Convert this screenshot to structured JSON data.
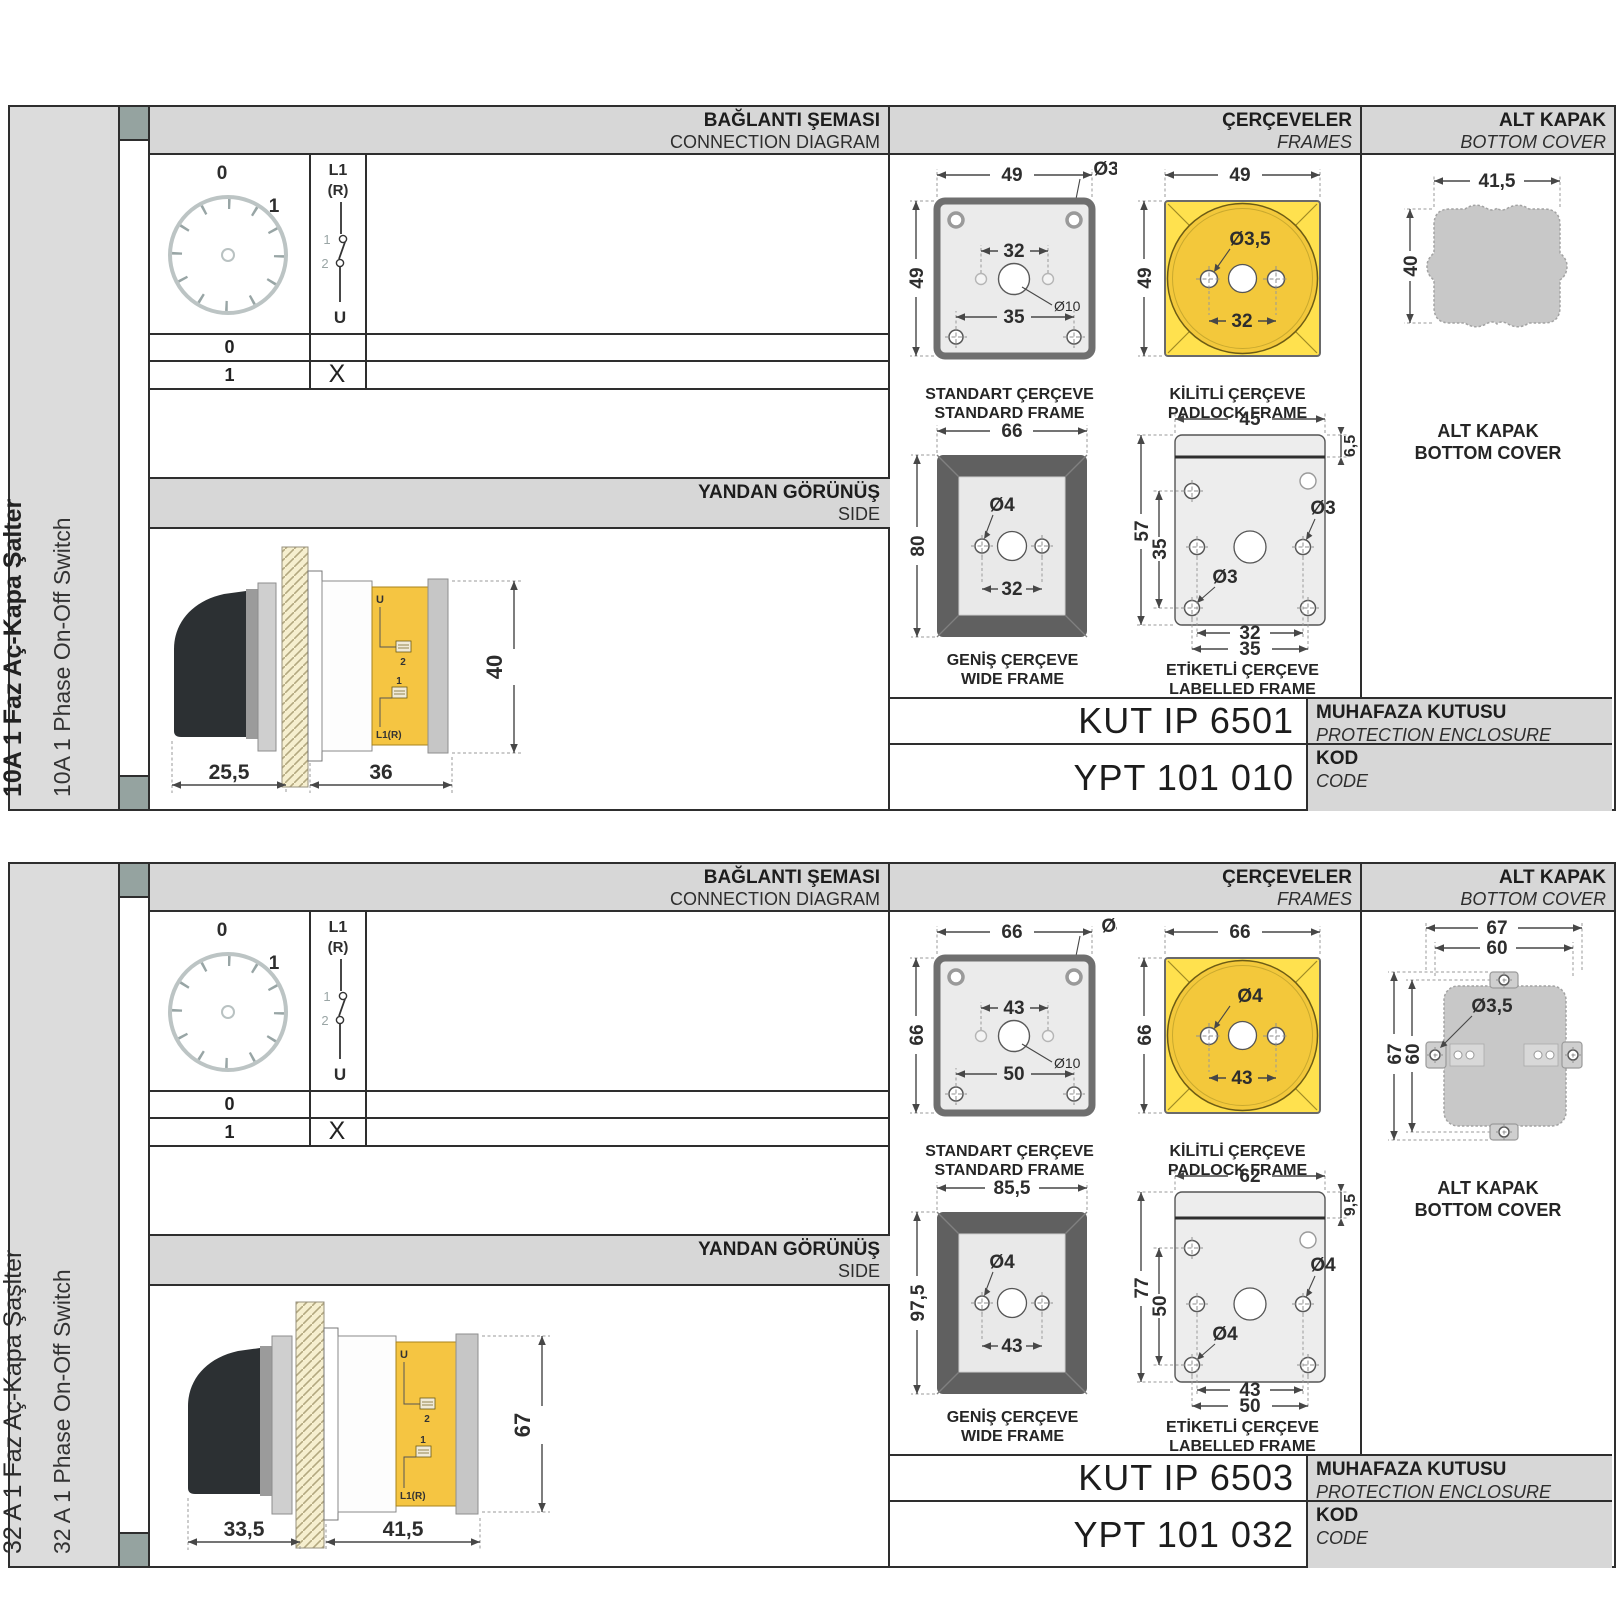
{
  "panels": [
    {
      "sidebar": {
        "title_tr": "10A 1 Faz Aç-Kapa Şalter",
        "title_en": "10A 1 Phase On-Off Switch"
      },
      "headers": {
        "connection_tr": "BAĞLANTI ŞEMASI",
        "connection_en": "CONNECTION DIAGRAM",
        "frames_tr": "ÇERÇEVELER",
        "frames_en": "FRAMES",
        "cover_tr": "ALT KAPAK",
        "cover_en": "BOTTOM COVER",
        "side_tr": "YANDAN GÖRÜNÜŞ",
        "side_en": "SIDE"
      },
      "connection": {
        "dial_zero": "0",
        "dial_one": "1",
        "line_in": "L1",
        "line_in2": "(R)",
        "contact_top": "1",
        "contact_bottom": "2",
        "line_out": "U",
        "rows": [
          {
            "pos": "0",
            "mark": ""
          },
          {
            "pos": "1",
            "mark": "X"
          }
        ]
      },
      "side_view": {
        "dim_handle": "25,5",
        "dim_body": "36",
        "dim_height": "40",
        "label_u": "U",
        "label_2": "2",
        "label_1": "1",
        "label_l1": "L1(R)"
      },
      "frames": {
        "standard": {
          "caption_tr": "STANDART ÇERÇEVE",
          "caption_en": "STANDARD FRAME",
          "dim_width": "49",
          "dim_height": "49",
          "dim_holes": "32",
          "dim_bottom": "35",
          "hole_corner": "Ø3,5",
          "hole_center": "Ø10"
        },
        "padlock": {
          "caption_tr": "KİLİTLİ ÇERÇEVE",
          "caption_en": "PADLOCK FRAME",
          "dim_width": "49",
          "dim_height": "49",
          "dim_holes": "32",
          "hole": "Ø3,5"
        },
        "wide": {
          "caption_tr": "GENİŞ ÇERÇEVE",
          "caption_en": "WIDE FRAME",
          "dim_width": "66",
          "dim_height": "80",
          "dim_holes": "32",
          "hole": "Ø4"
        },
        "labelled": {
          "caption_tr": "ETİKETLİ ÇERÇEVE",
          "caption_en": "LABELLED FRAME",
          "dim_width": "45",
          "dim_strip": "6,5",
          "dim_height": "57",
          "dim_inner": "35",
          "hole_mid": "Ø3",
          "hole_bottom": "Ø3",
          "dim_holes_inner": "32",
          "dim_holes_outer": "35"
        }
      },
      "cover": {
        "caption_tr": "ALT KAPAK",
        "caption_en": "BOTTOM COVER",
        "dim_width": "41,5",
        "dim_height": "40"
      },
      "codes": {
        "enclosure_value": "KUT IP 6501",
        "enclosure_tr": "MUHAFAZA KUTUSU",
        "enclosure_en": "PROTECTION ENCLOSURE",
        "code_value": "YPT 101 010",
        "code_tr": "KOD",
        "code_en": "CODE"
      }
    },
    {
      "sidebar": {
        "title_tr": "32 A 1 Faz Aç-Kapa Şaşlter",
        "title_en": "32 A 1 Phase On-Off Switch"
      },
      "headers": {
        "connection_tr": "BAĞLANTI ŞEMASI",
        "connection_en": "CONNECTION DIAGRAM",
        "frames_tr": "ÇERÇEVELER",
        "frames_en": "FRAMES",
        "cover_tr": "ALT KAPAK",
        "cover_en": "BOTTOM COVER",
        "side_tr": "YANDAN GÖRÜNÜŞ",
        "side_en": "SIDE"
      },
      "connection": {
        "dial_zero": "0",
        "dial_one": "1",
        "line_in": "L1",
        "line_in2": "(R)",
        "contact_top": "1",
        "contact_bottom": "2",
        "line_out": "U",
        "rows": [
          {
            "pos": "0",
            "mark": ""
          },
          {
            "pos": "1",
            "mark": "X"
          }
        ]
      },
      "side_view": {
        "dim_handle": "33,5",
        "dim_body": "41,5",
        "dim_height": "67",
        "label_u": "U",
        "label_2": "2",
        "label_1": "1",
        "label_l1": "L1(R)"
      },
      "frames": {
        "standard": {
          "caption_tr": "STANDART ÇERÇEVE",
          "caption_en": "STANDARD FRAME",
          "dim_width": "66",
          "dim_height": "66",
          "dim_holes": "43",
          "dim_bottom": "50",
          "hole_corner": "Ø4",
          "hole_center": "Ø10"
        },
        "padlock": {
          "caption_tr": "KİLİTLİ ÇERÇEVE",
          "caption_en": "PADLOCK FRAME",
          "dim_width": "66",
          "dim_height": "66",
          "dim_holes": "43",
          "hole": "Ø4"
        },
        "wide": {
          "caption_tr": "GENİŞ ÇERÇEVE",
          "caption_en": "WIDE FRAME",
          "dim_width": "85,5",
          "dim_height": "97,5",
          "dim_holes": "43",
          "hole": "Ø4"
        },
        "labelled": {
          "caption_tr": "ETİKETLİ ÇERÇEVE",
          "caption_en": "LABELLED FRAME",
          "dim_width": "62",
          "dim_strip": "9,5",
          "dim_height": "77",
          "dim_inner": "50",
          "hole_mid": "Ø4",
          "hole_bottom": "Ø4",
          "dim_holes_inner": "43",
          "dim_holes_outer": "50"
        }
      },
      "cover": {
        "caption_tr": "ALT KAPAK",
        "caption_en": "BOTTOM COVER",
        "dim_width": "67",
        "dim_width_inner": "60",
        "dim_height": "67",
        "dim_height_inner": "60",
        "hole": "Ø3,5"
      },
      "codes": {
        "enclosure_value": "KUT IP 6503",
        "enclosure_tr": "MUHAFAZA KUTUSU",
        "enclosure_en": "PROTECTION ENCLOSURE",
        "code_value": "YPT 101 032",
        "code_tr": "KOD",
        "code_en": "CODE"
      }
    }
  ]
}
